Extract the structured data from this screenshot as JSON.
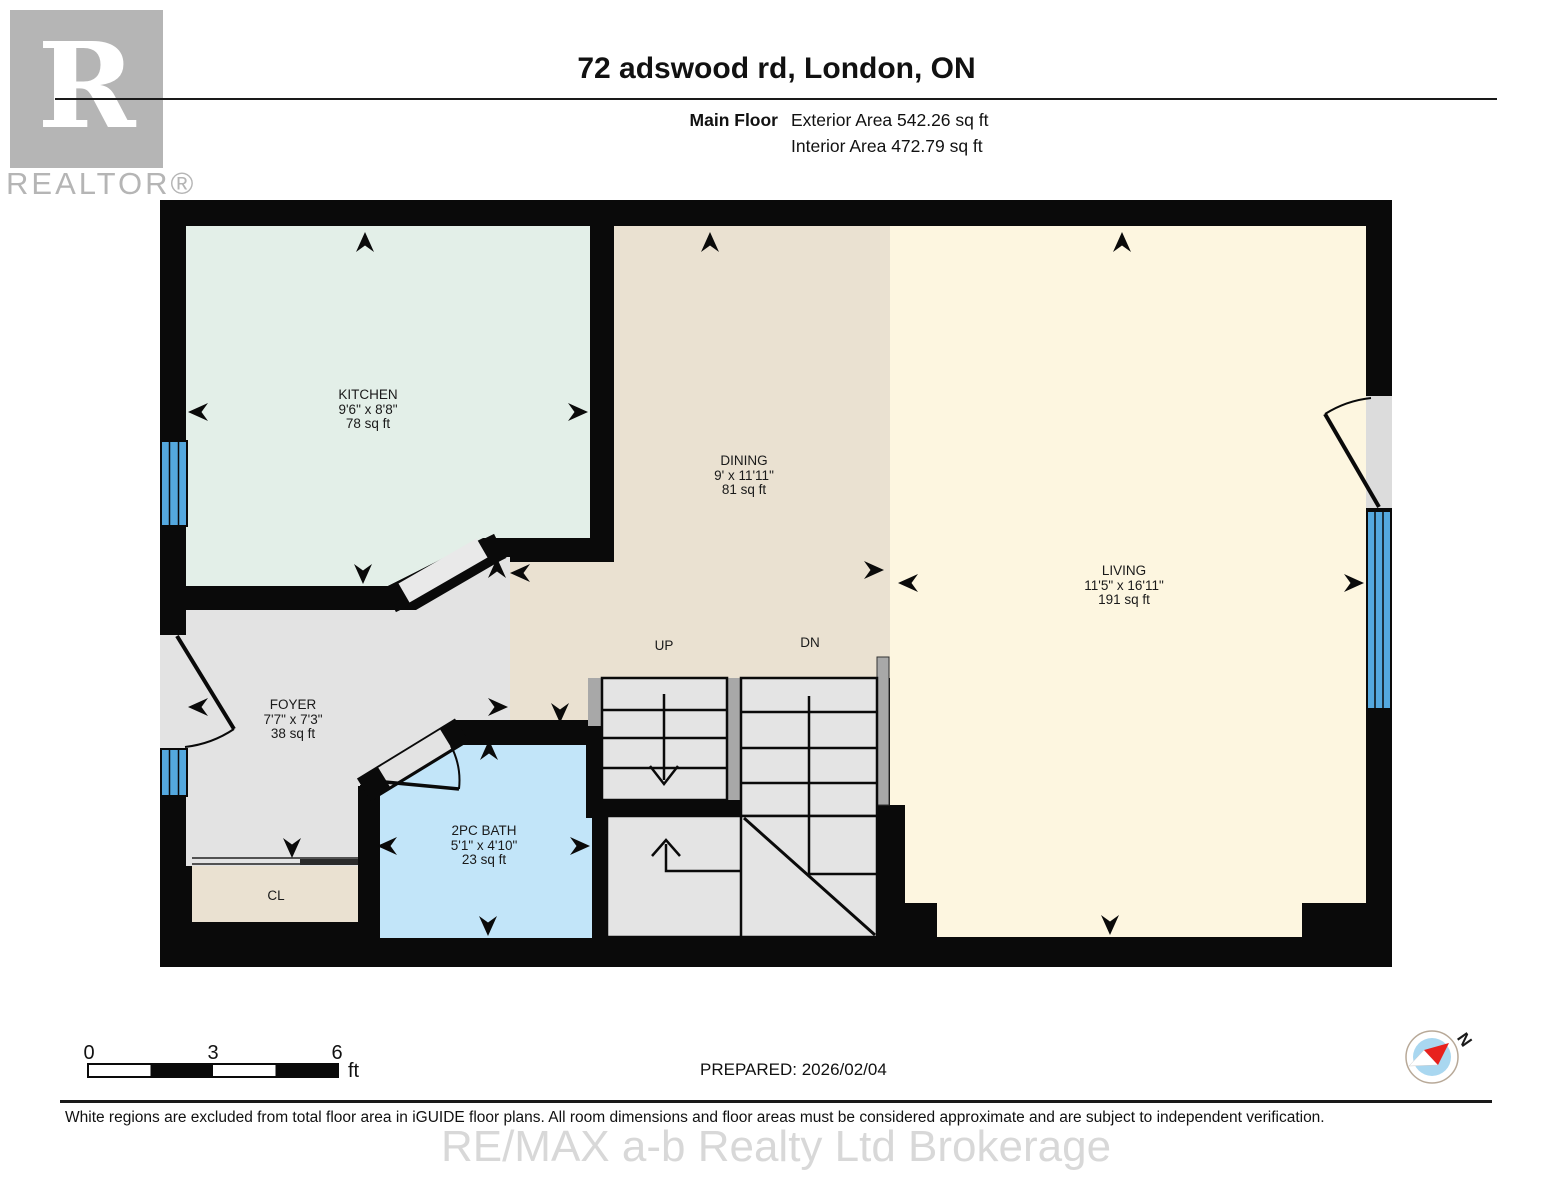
{
  "header": {
    "title": "72 adswood rd, London, ON",
    "floor_label": "Main Floor",
    "exterior_area": "Exterior Area 542.26 sq ft",
    "interior_area": "Interior Area 472.79 sq ft"
  },
  "logo": {
    "letter": "R",
    "word": "REALTOR®"
  },
  "rooms": [
    {
      "id": "kitchen",
      "name": "KITCHEN",
      "dims": "9'6\" x 8'8\"",
      "area": "78 sq ft"
    },
    {
      "id": "dining",
      "name": "DINING",
      "dims": "9' x 11'11\"",
      "area": "81 sq ft"
    },
    {
      "id": "living",
      "name": "LIVING",
      "dims": "11'5\" x 16'11\"",
      "area": "191 sq ft"
    },
    {
      "id": "foyer",
      "name": "FOYER",
      "dims": "7'7\" x 7'3\"",
      "area": "38 sq ft"
    },
    {
      "id": "bath",
      "name": "2PC BATH",
      "dims": "5'1\" x 4'10\"",
      "area": "23 sq ft"
    }
  ],
  "labels": {
    "closet": "CL",
    "up": "UP",
    "down": "DN",
    "north": "N"
  },
  "scale_bar": {
    "start": "0",
    "mid": "3",
    "end": "6",
    "unit": "ft"
  },
  "footer": {
    "prepared": "PREPARED: 2026/02/04",
    "disclaimer": "White regions are excluded from total floor area in iGUIDE floor plans. All room dimensions and floor areas must be considered approximate and are subject to independent verification.",
    "watermark": "RE/MAX a-b Realty Ltd Brokerage"
  },
  "colors": {
    "wall": "#0a0a0a",
    "kitchen": "#e3efe8",
    "dining": "#eae1d1",
    "living": "#fdf6e0",
    "foyer": "#e3e3e3",
    "bath": "#c2e5f9",
    "stair": "#e4e4e4",
    "rail": "#a8a8a8",
    "window": "#54a8de",
    "compass_inner": "#a9d7f0",
    "compass_red": "#e8211d"
  }
}
